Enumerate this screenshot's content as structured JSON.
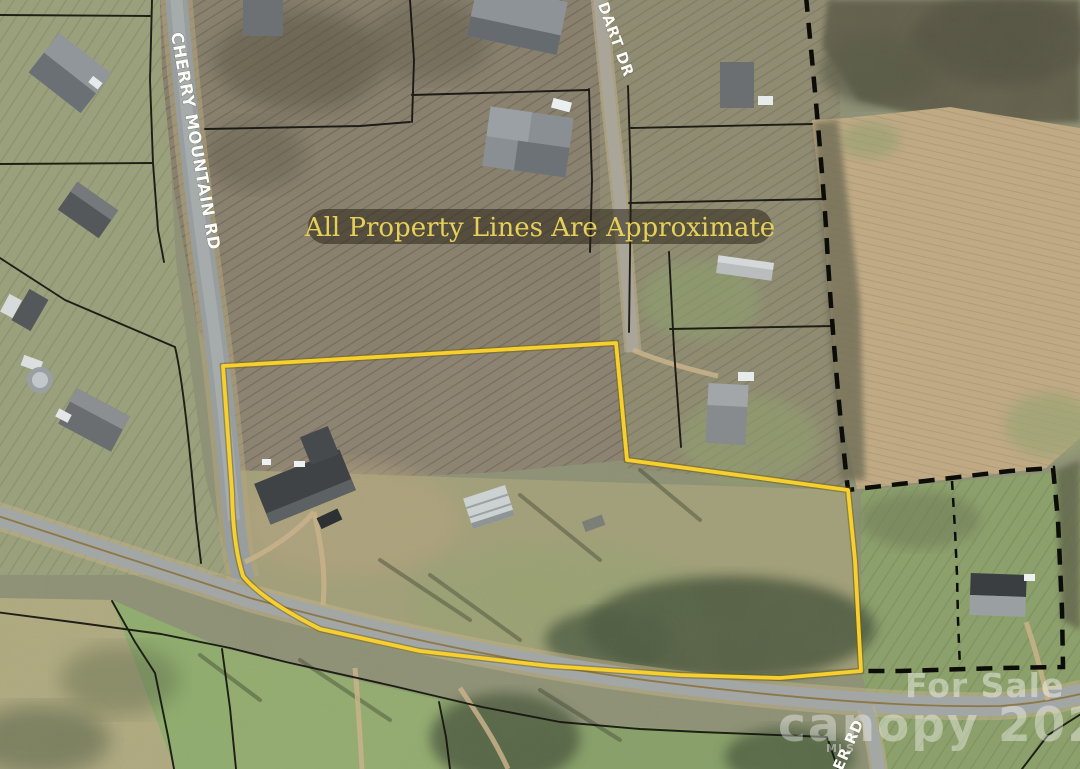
{
  "banner": {
    "text": "All Property Lines Are Approximate",
    "text_color": "#e6d059",
    "bg_color": "rgba(38,32,20,0.52)"
  },
  "roads": {
    "cherry_mountain": {
      "label": "CHERRY MOUNTAIN RD"
    },
    "dart": {
      "label": "DART DR"
    },
    "er": {
      "label": "ER RD"
    }
  },
  "watermark": {
    "for_sale": "For Sale",
    "brand_year": "canopy 2025",
    "mls": "MLS"
  },
  "colors": {
    "property_outline": "#f7d02e",
    "parcel_line": "#14130e",
    "dashed_line": "#0c0c09"
  }
}
